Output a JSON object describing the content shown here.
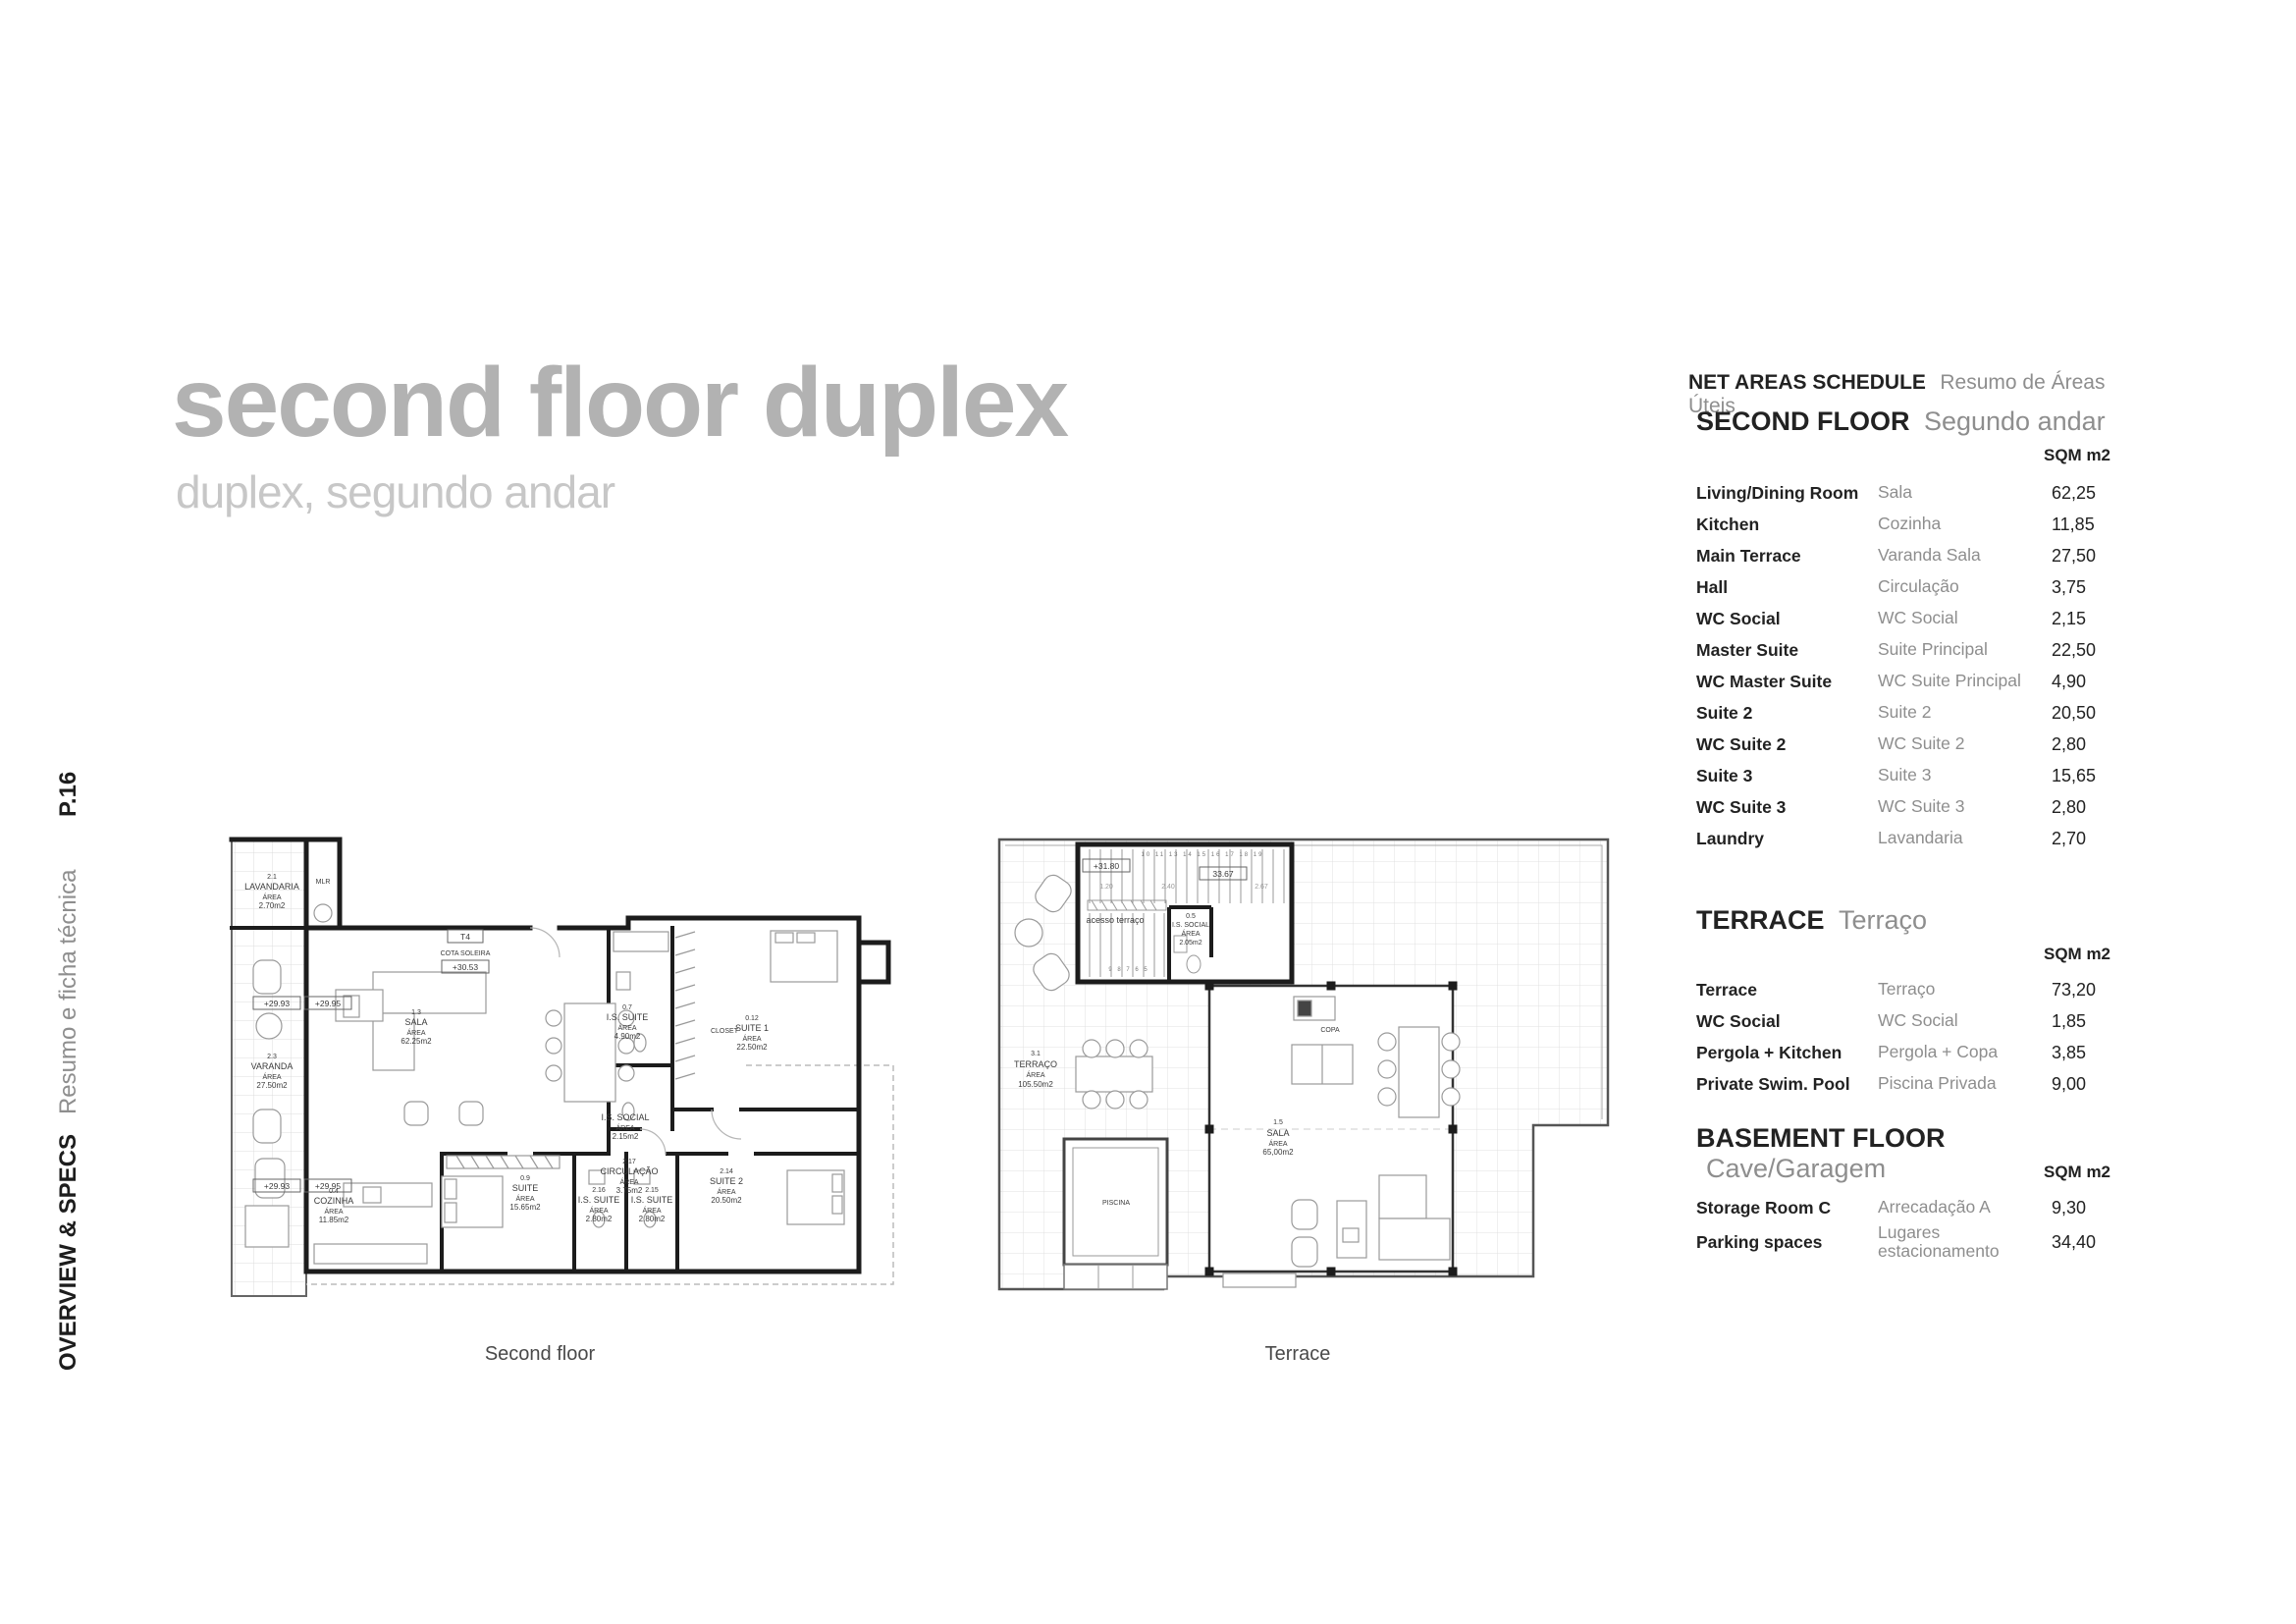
{
  "page": {
    "title": "second floor duplex",
    "subtitle": "duplex, segundo andar",
    "page_number": "P.16",
    "sidebar_bold": "OVERVIEW & SPECS",
    "sidebar_gray": "Resumo e ficha técnica"
  },
  "schedule": {
    "title_en": "NET AREAS SCHEDULE",
    "title_pt": "Resumo de Áreas Úteis",
    "unit_label": "SQM m2",
    "sections": [
      {
        "heading_en": "SECOND FLOOR",
        "heading_pt": "Segundo andar",
        "rows": [
          {
            "en": "Living/Dining Room",
            "pt": "Sala",
            "sqm": "62,25"
          },
          {
            "en": "Kitchen",
            "pt": "Cozinha",
            "sqm": "11,85"
          },
          {
            "en": "Main Terrace",
            "pt": "Varanda Sala",
            "sqm": "27,50"
          },
          {
            "en": "Hall",
            "pt": "Circulação",
            "sqm": "3,75"
          },
          {
            "en": "WC Social",
            "pt": "WC Social",
            "sqm": "2,15"
          },
          {
            "en": "Master Suite",
            "pt": "Suite Principal",
            "sqm": "22,50"
          },
          {
            "en": "WC Master Suite",
            "pt": "WC Suite Principal",
            "sqm": "4,90"
          },
          {
            "en": "Suite 2",
            "pt": "Suite 2",
            "sqm": "20,50"
          },
          {
            "en": "WC Suite 2",
            "pt": "WC Suite 2",
            "sqm": "2,80"
          },
          {
            "en": "Suite 3",
            "pt": "Suite 3",
            "sqm": "15,65"
          },
          {
            "en": "WC Suite 3",
            "pt": "WC Suite 3",
            "sqm": "2,80"
          },
          {
            "en": "Laundry",
            "pt": "Lavandaria",
            "sqm": "2,70"
          }
        ]
      },
      {
        "heading_en": "TERRACE",
        "heading_pt": "Terraço",
        "rows": [
          {
            "en": "Terrace",
            "pt": "Terraço",
            "sqm": "73,20"
          },
          {
            "en": "WC Social",
            "pt": "WC Social",
            "sqm": "1,85"
          },
          {
            "en": "Pergola + Kitchen",
            "pt": "Pergola + Copa",
            "sqm": "3,85"
          },
          {
            "en": "Private Swim. Pool",
            "pt": "Piscina Privada",
            "sqm": "9,00"
          }
        ]
      },
      {
        "heading_en": "BASEMENT FLOOR",
        "heading_pt": "Cave/Garagem",
        "rows": [
          {
            "en": "Storage Room C",
            "pt": "Arrecadação A",
            "sqm": "9,30"
          },
          {
            "en": "Parking spaces",
            "pt": "Lugares estacionamento",
            "sqm": "34,40"
          }
        ]
      }
    ]
  },
  "plans": {
    "second_floor": {
      "caption": "Second floor",
      "labels": {
        "lavandaria": [
          "2.1",
          "LAVANDARIA",
          "ÁREA",
          "2.70m2"
        ],
        "mlr": [
          "MLR"
        ],
        "t4": [
          "T4"
        ],
        "cota": [
          "COTA SOLEIRA"
        ],
        "cota_val": [
          "+30.53"
        ],
        "elev_a": [
          "+29.93"
        ],
        "elev_b": [
          "+29.95"
        ],
        "elev_c": [
          "+29.93"
        ],
        "elev_d": [
          "+29.95"
        ],
        "sala": [
          "1.3",
          "SALA",
          "ÁREA",
          "62.25m2"
        ],
        "varanda": [
          "2.3",
          "VARANDA",
          "ÁREA",
          "27.50m2"
        ],
        "is_suite_top": [
          "0.7",
          "I.S. SUITE",
          "ÁREA",
          "4.90m2"
        ],
        "closet": [
          "CLOSET"
        ],
        "suite1": [
          "0.12",
          "SUITE 1",
          "ÁREA",
          "22.50m2"
        ],
        "is_social": [
          "I.S. SOCIAL",
          "ÁREA",
          "2.15m2"
        ],
        "circulacao": [
          "2.17",
          "CIRCULAÇÃO",
          "ÁREA",
          "3.75m2"
        ],
        "cozinha": [
          "0.4",
          "COZINHA",
          "ÁREA",
          "11.85m2"
        ],
        "suite": [
          "0.9",
          "SUITE",
          "ÁREA",
          "15.65m2"
        ],
        "is_suite_a": [
          "2.16",
          "I.S. SUITE",
          "ÁREA",
          "2.80m2"
        ],
        "is_suite_b": [
          "2.15",
          "I.S. SUITE",
          "ÁREA",
          "2.80m2"
        ],
        "suite2": [
          "2.14",
          "SUITE 2",
          "ÁREA",
          "20.50m2"
        ]
      }
    },
    "terrace": {
      "caption": "Terrace",
      "labels": {
        "elev": [
          "+31.80"
        ],
        "dim_total": [
          "33.67"
        ],
        "dim1": [
          "1.20"
        ],
        "dim2": [
          "2.40"
        ],
        "dim3": [
          "2.67"
        ],
        "stair_top": [
          "10 11 13 14 15 16 17 18 19"
        ],
        "stair_bottom": [
          "9  8  7  6  5"
        ],
        "acesso": [
          "acesso  terraço"
        ],
        "is_social": [
          "0.5",
          "I.S. SOCIAL",
          "ÁREA",
          "2.05m2"
        ],
        "terraco": [
          "3.1",
          "TERRAÇO",
          "ÁREA",
          "105.50m2"
        ],
        "piscina": [
          "PISCINA"
        ],
        "sala": [
          "1.5",
          "SALA",
          "ÁREA",
          "65,00m2"
        ],
        "copa": [
          "COPA"
        ]
      }
    }
  }
}
